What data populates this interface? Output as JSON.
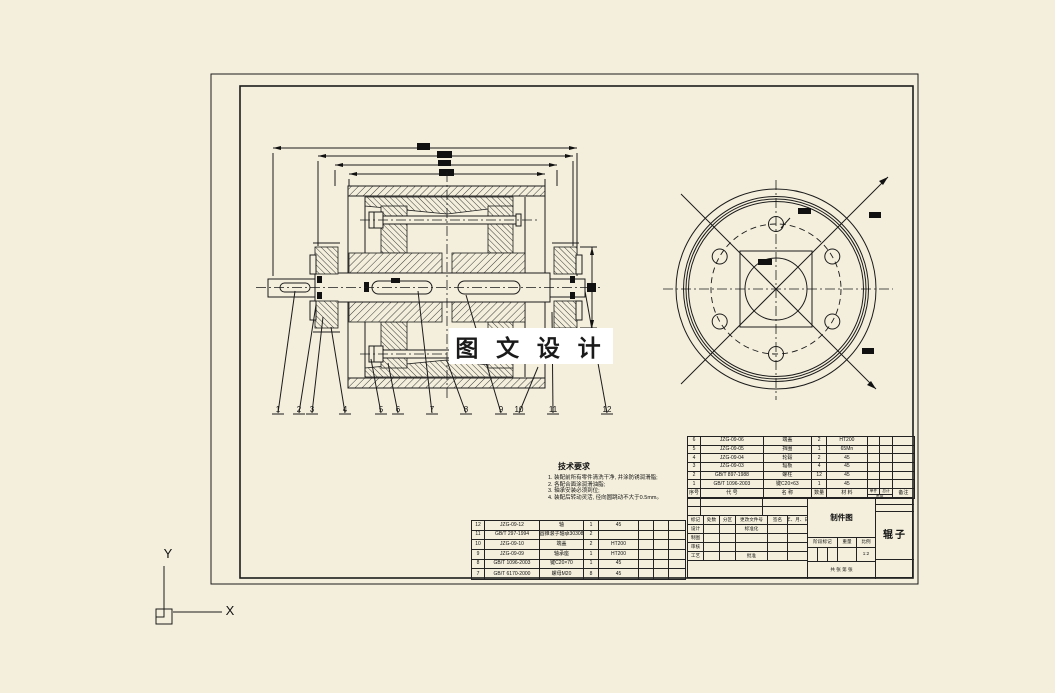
{
  "colors": {
    "background": "#f4efdc",
    "line": "#1b1b1b",
    "watermark_bg": "#ffffff"
  },
  "watermark": {
    "text": "图 文 设 计"
  },
  "ucs": {
    "x_label": "X",
    "y_label": "Y"
  },
  "tech_notes": {
    "title": "技术要求",
    "lines": [
      "1. 装配前所有零件清洗干净, 并涂防锈润滑脂;",
      "2. 各配合面涂润滑油脂;",
      "3. 轴承安装必须到位;",
      "4. 装配后转动灵活, 径向圆跳动不大于0.5mm。"
    ]
  },
  "balloons": [
    "1",
    "2",
    "3",
    "4",
    "5",
    "6",
    "7",
    "8",
    "9",
    "10",
    "11",
    "12"
  ],
  "bom_right": {
    "header": {
      "no": "序号",
      "code": "代  号",
      "name": "名  称",
      "qty": "数量",
      "material": "材  料",
      "unit": "单件",
      "total": "总计",
      "weight": "重量",
      "remark": "备注"
    },
    "rows": [
      {
        "no": "6",
        "code": "JZG-09-06",
        "name": "端盖",
        "qty": "2",
        "material": "HT200"
      },
      {
        "no": "5",
        "code": "JZG-09-05",
        "name": "挡圈",
        "qty": "1",
        "material": "65Mn"
      },
      {
        "no": "4",
        "code": "JZG-09-04",
        "name": "轮毂",
        "qty": "2",
        "material": "45"
      },
      {
        "no": "3",
        "code": "JZG-09-03",
        "name": "辐板",
        "qty": "4",
        "material": "45"
      },
      {
        "no": "2",
        "code": "GB/T 897-1988",
        "name": "螺柱",
        "qty": "12",
        "material": "45"
      },
      {
        "no": "1",
        "code": "GB/T 1096-2003",
        "name": "键C20×63",
        "qty": "1",
        "material": "45"
      }
    ]
  },
  "bom_left": {
    "rows": [
      {
        "no": "12",
        "code": "JZG-09-12",
        "name": "轴",
        "qty": "1",
        "material": "45"
      },
      {
        "no": "11",
        "code": "GB/T 297-1994",
        "name": "圆锥滚子轴承30308",
        "qty": "2",
        "material": ""
      },
      {
        "no": "10",
        "code": "JZG-09-10",
        "name": "端盖",
        "qty": "2",
        "material": "HT200"
      },
      {
        "no": "9",
        "code": "JZG-09-09",
        "name": "轴承座",
        "qty": "1",
        "material": "HT200"
      },
      {
        "no": "8",
        "code": "GB/T 1096-2003",
        "name": "键C20×70",
        "qty": "1",
        "material": "45"
      },
      {
        "no": "7",
        "code": "GB/T 6170-2000",
        "name": "螺母M20",
        "qty": "8",
        "material": "45"
      }
    ]
  },
  "title_block": {
    "revision_header": [
      "标记",
      "处数",
      "分区",
      "更改文件号",
      "签名",
      "年、月、日"
    ],
    "design_label": "设计",
    "standardization_label": "标准化",
    "draft_label": "制图",
    "check_label": "审核",
    "process_label": "工艺",
    "approve_label": "批准",
    "stage_label": "阶段标记",
    "weight_label": "重量",
    "scale_label": "比例",
    "scale_value": "1:2",
    "sheet_label": "共 张 第 张",
    "drawing_name": "制件图",
    "part_name": "辊子"
  }
}
